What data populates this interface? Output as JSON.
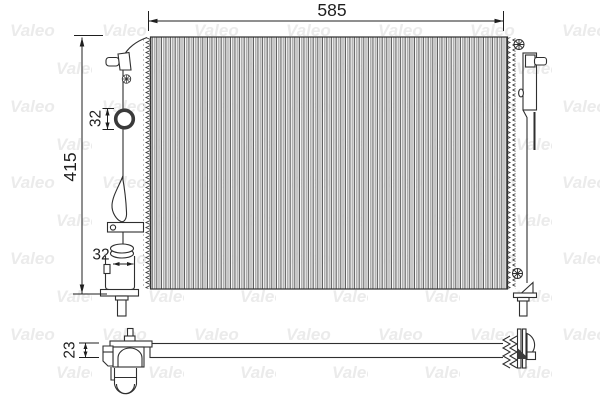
{
  "drawing": {
    "watermark": {
      "text": "Valeo",
      "color": "#ebebeb"
    },
    "front_view": {
      "width_mm": "585",
      "height_mm": "415",
      "top_port_diameter_mm": "32",
      "bottom_port_diameter_mm": "32"
    },
    "side_view": {
      "thickness_mm": "23"
    }
  }
}
